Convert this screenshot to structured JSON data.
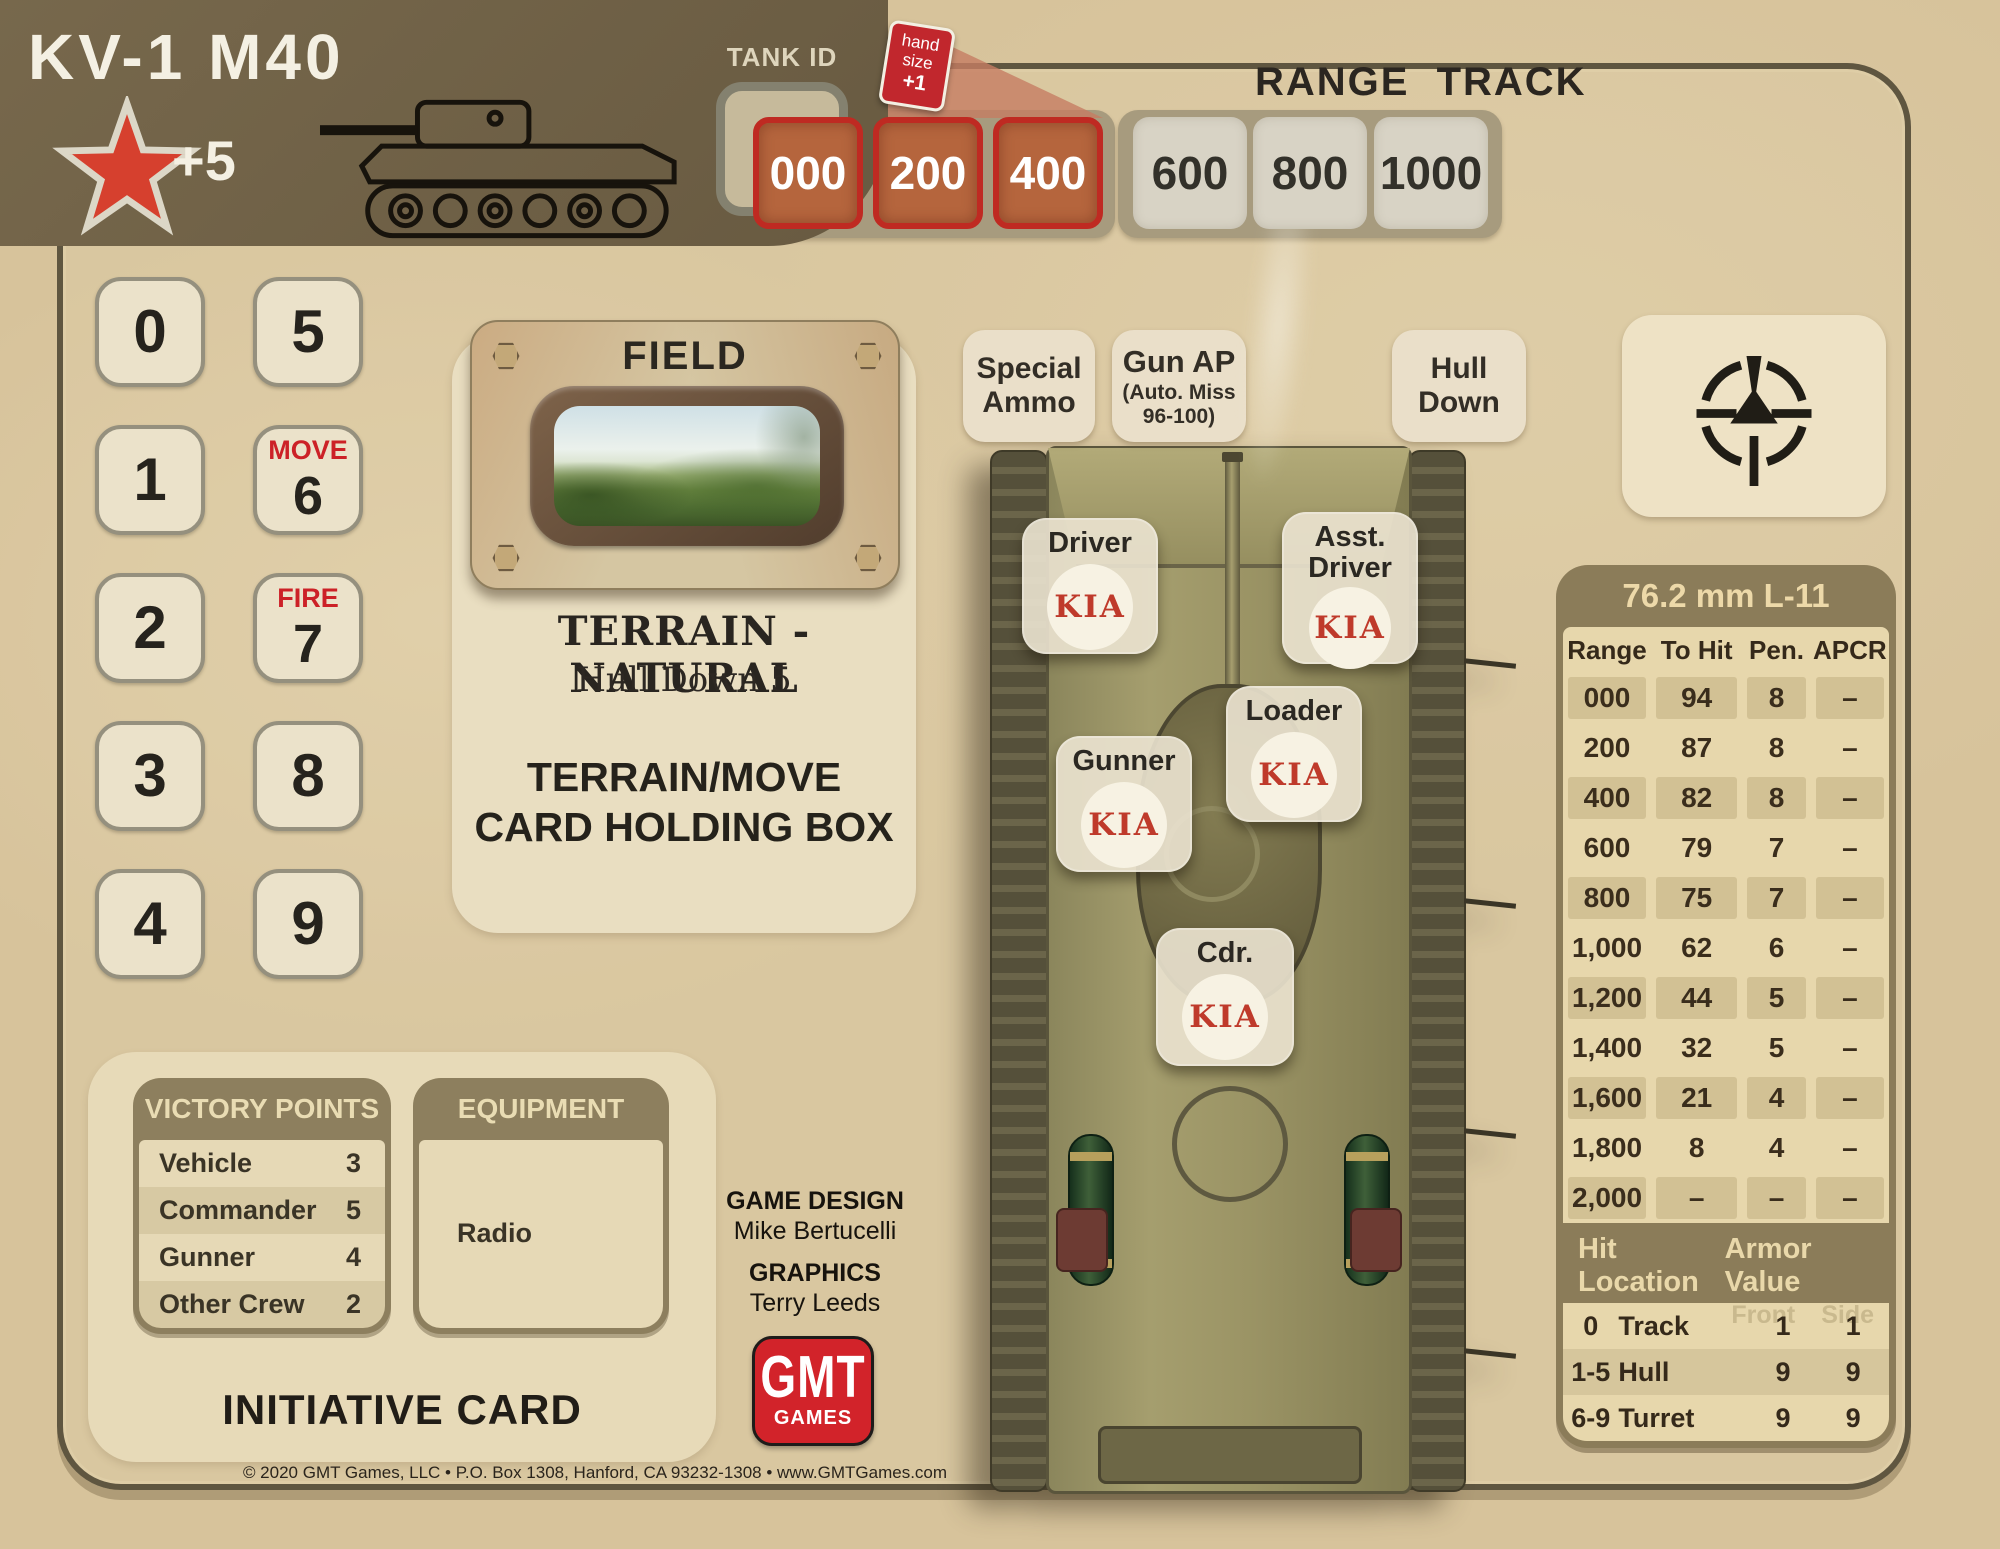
{
  "colors": {
    "hot_box": "#b5653d",
    "hot_border": "#bf2a22",
    "badge_red": "#c1272d",
    "kia_red": "#bf3a2b",
    "move_fire_red": "#cc2127",
    "gmt_red": "#d2232a",
    "panel_olive": "#8b7c59"
  },
  "header": {
    "title": "KV-1 M40",
    "star_bonus": "+5",
    "tank_id_label": "TANK ID"
  },
  "range_track": {
    "title": "RANGE TRACK",
    "badge": [
      "hand",
      "size",
      "+1"
    ],
    "near": [
      "000",
      "200",
      "400"
    ],
    "far": [
      "600",
      "800",
      "1000"
    ]
  },
  "keypad": {
    "left": [
      "0",
      "1",
      "2",
      "3",
      "4"
    ],
    "right": [
      "5",
      "6",
      "7",
      "8",
      "9"
    ],
    "move_label": "MOVE",
    "fire_label": "FIRE"
  },
  "terrain_card": {
    "title": "FIELD",
    "type": "TERRAIN - NATURAL",
    "modifier": "Hull Down 5"
  },
  "holding_box": {
    "label": "TERRAIN/MOVE CARD HOLDING BOX"
  },
  "actions": {
    "special_ammo": "Special Ammo",
    "gun_ap": "Gun AP",
    "gun_ap_note": "(Auto. Miss 96-100)",
    "hull_down": "Hull Down"
  },
  "crew": [
    {
      "name": "Driver",
      "status": "KIA"
    },
    {
      "name": "Asst. Driver",
      "status": "KIA"
    },
    {
      "name": "Loader",
      "status": "KIA"
    },
    {
      "name": "Gunner",
      "status": "KIA"
    },
    {
      "name": "Cdr.",
      "status": "KIA"
    }
  ],
  "gun_table": {
    "title": "76.2 mm L-11",
    "columns": [
      "Range",
      "To Hit",
      "Pen.",
      "APCR"
    ],
    "rows": [
      [
        "000",
        "94",
        "8",
        "–"
      ],
      [
        "200",
        "87",
        "8",
        "–"
      ],
      [
        "400",
        "82",
        "8",
        "–"
      ],
      [
        "600",
        "79",
        "7",
        "–"
      ],
      [
        "800",
        "75",
        "7",
        "–"
      ],
      [
        "1,000",
        "62",
        "6",
        "–"
      ],
      [
        "1,200",
        "44",
        "5",
        "–"
      ],
      [
        "1,400",
        "32",
        "5",
        "–"
      ],
      [
        "1,600",
        "21",
        "4",
        "–"
      ],
      [
        "1,800",
        "8",
        "4",
        "–"
      ],
      [
        "2,000",
        "–",
        "–",
        "–"
      ]
    ]
  },
  "hit_location": {
    "title": "Hit Location",
    "armor_title": "Armor Value",
    "sub_columns": [
      "Front",
      "Side"
    ],
    "rows": [
      [
        "0",
        "Track",
        "1",
        "1"
      ],
      [
        "1-5",
        "Hull",
        "9",
        "9"
      ],
      [
        "6-9",
        "Turret",
        "9",
        "9"
      ]
    ]
  },
  "victory_points": {
    "title": "VICTORY POINTS",
    "rows": [
      [
        "Vehicle",
        "3"
      ],
      [
        "Commander",
        "5"
      ],
      [
        "Gunner",
        "4"
      ],
      [
        "Other Crew",
        "2"
      ]
    ]
  },
  "equipment": {
    "title": "EQUIPMENT",
    "items": [
      "Radio"
    ]
  },
  "initiative": {
    "label": "INITIATIVE CARD"
  },
  "credits": {
    "design_label": "GAME DESIGN",
    "designer": "Mike Bertucelli",
    "graphics_label": "GRAPHICS",
    "artist": "Terry Leeds",
    "logo_line1": "GMT",
    "logo_line2": "GAMES"
  },
  "footer": {
    "copyright": "© 2020 GMT Games, LLC • P.O. Box 1308, Hanford, CA 93232-1308 • www.GMTGames.com"
  }
}
